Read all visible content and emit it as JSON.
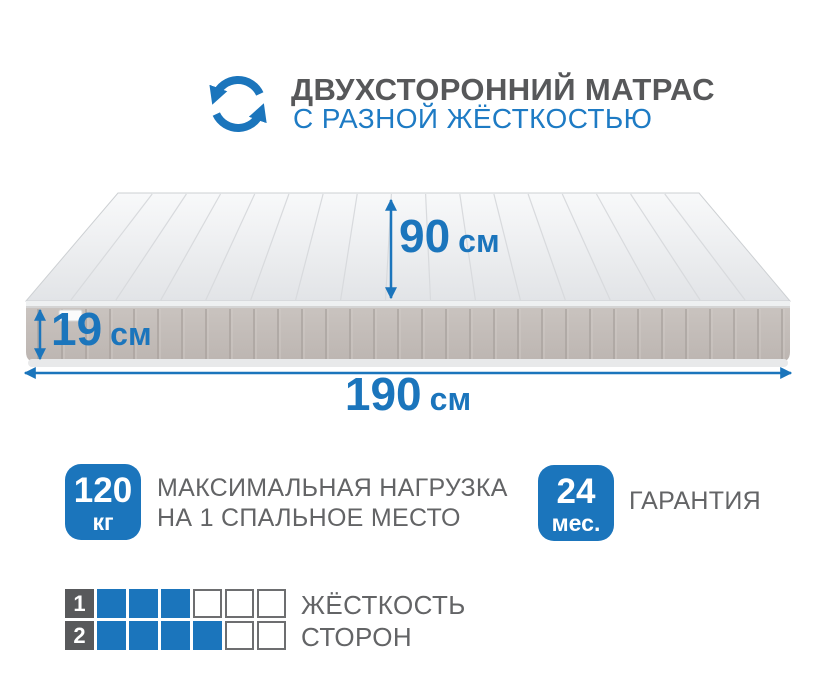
{
  "header": {
    "title": "ДВУХСТОРОННИЙ МАТРАС",
    "subtitle": "С РАЗНОЙ ЖЁСТКОСТЬЮ",
    "icon": "rotate-arrows"
  },
  "dimensions": {
    "width": {
      "value": "90",
      "unit": "см"
    },
    "height": {
      "value": "19",
      "unit": "см"
    },
    "length": {
      "value": "190",
      "unit": "см"
    }
  },
  "features": {
    "max_load": {
      "badge_value": "120",
      "badge_unit": "кг",
      "label_line1": "МАКСИМАЛЬНАЯ НАГРУЗКА",
      "label_line2": "НА 1 СПАЛЬНОЕ МЕСТО"
    },
    "warranty": {
      "badge_value": "24",
      "badge_unit": "мес.",
      "label": "ГАРАНТИЯ"
    }
  },
  "firmness": {
    "label_line1": "ЖЁСТКОСТЬ",
    "label_line2": "СТОРОН",
    "scale_max": 6,
    "rows": [
      {
        "side": "1",
        "filled": 3
      },
      {
        "side": "2",
        "filled": 4
      }
    ]
  },
  "colors": {
    "accent_blue": "#1b75bc",
    "subtitle_blue": "#1e7bc4",
    "title_gray": "#57585a",
    "label_gray": "#636466",
    "mattress_top": "#eceef0",
    "mattress_side": "#c2bbb7"
  }
}
